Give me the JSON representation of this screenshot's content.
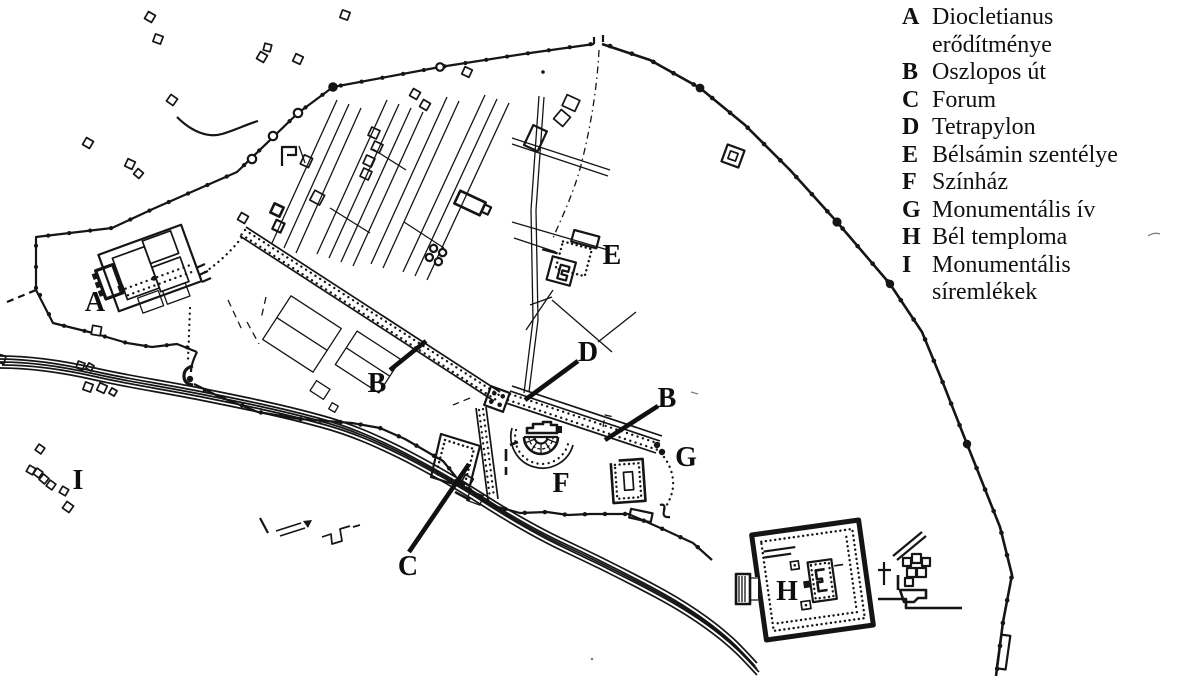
{
  "colors": {
    "background": "#ffffff",
    "ink": "#151515"
  },
  "legend": {
    "items": [
      {
        "letter": "A",
        "label": "Diocletianus erődítménye"
      },
      {
        "letter": "B",
        "label": "Oszlopos út"
      },
      {
        "letter": "C",
        "label": "Forum"
      },
      {
        "letter": "D",
        "label": "Tetrapylon"
      },
      {
        "letter": "E",
        "label": "Bélsámin szentélye"
      },
      {
        "letter": "F",
        "label": "Színház"
      },
      {
        "letter": "G",
        "label": "Monumentális ív"
      },
      {
        "letter": "H",
        "label": "Bél temploma"
      },
      {
        "letter": "I",
        "label": "Monumentális síremlékek"
      }
    ]
  },
  "map": {
    "labels": [
      {
        "letter": "A"
      },
      {
        "letter": "B"
      },
      {
        "letter": "C"
      },
      {
        "letter": "D"
      },
      {
        "letter": "E"
      },
      {
        "letter": "F"
      },
      {
        "letter": "B"
      },
      {
        "letter": "G"
      },
      {
        "letter": "H"
      },
      {
        "letter": "I"
      }
    ]
  }
}
